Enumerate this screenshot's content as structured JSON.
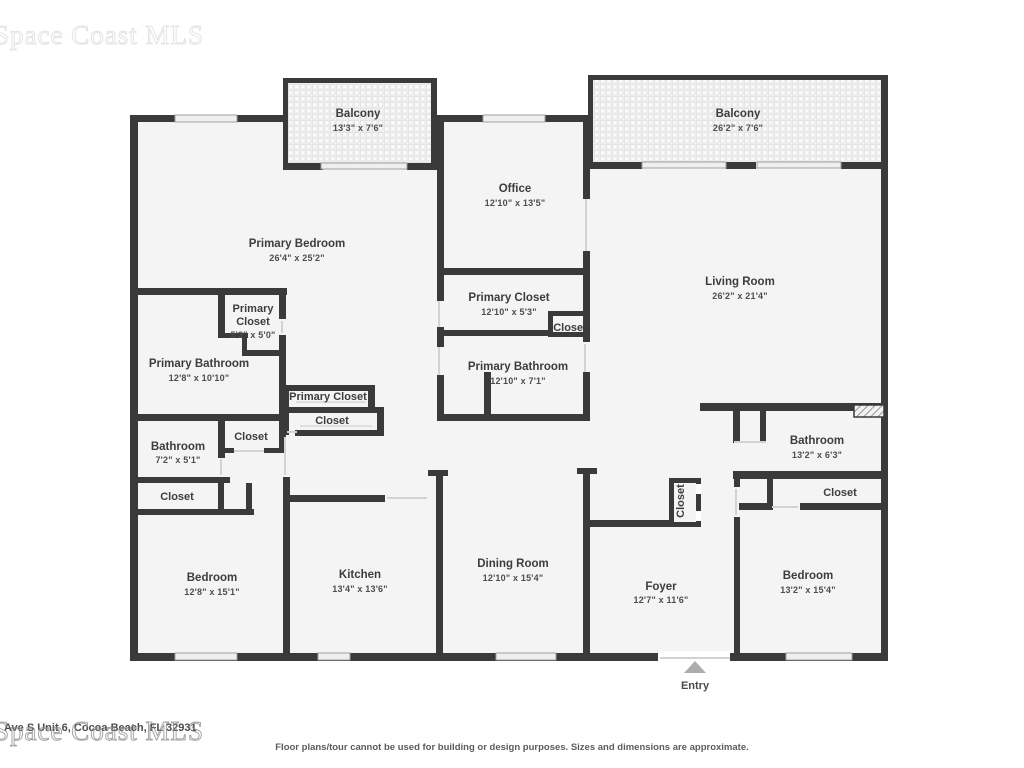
{
  "watermark": {
    "text": "Space Coast MLS"
  },
  "rooms": {
    "balcony_left": {
      "name": "Balcony",
      "dims": "13'3\" x 7'6\""
    },
    "balcony_right": {
      "name": "Balcony",
      "dims": "26'2\" x 7'6\""
    },
    "office": {
      "name": "Office",
      "dims": "12'10\" x 13'5\""
    },
    "primary_bedroom": {
      "name": "Primary Bedroom",
      "dims": "26'4\" x 25'2\""
    },
    "primary_closet_mid": {
      "name": "Primary Closet",
      "dims": "12'10\" x 5'3\""
    },
    "closet_mid": {
      "name": "Closet"
    },
    "primary_bathroom_mid": {
      "name": "Primary Bathroom",
      "dims": "12'10\" x 7'1\""
    },
    "primary_closet_small": {
      "line1": "Primary",
      "line2": "Closet",
      "dims": "5'3\" x 5'0\""
    },
    "primary_bathroom_left": {
      "name": "Primary Bathroom",
      "dims": "12'8\" x 10'10\""
    },
    "primary_closet_hall": {
      "name": "Primary Closet"
    },
    "closet_hall": {
      "name": "Closet"
    },
    "bathroom_left": {
      "name": "Bathroom",
      "dims": "7'2\" x 5'1\""
    },
    "closet_bath": {
      "name": "Closet"
    },
    "closet_bedroom_left": {
      "name": "Closet"
    },
    "bedroom_left": {
      "name": "Bedroom",
      "dims": "12'8\" x 15'1\""
    },
    "kitchen": {
      "name": "Kitchen",
      "dims": "13'4\" x 13'6\""
    },
    "living_room": {
      "name": "Living Room",
      "dims": "26'2\" x 21'4\""
    },
    "bathroom_right": {
      "name": "Bathroom",
      "dims": "13'2\" x 6'3\""
    },
    "closet_right": {
      "name": "Closet"
    },
    "dining_room": {
      "name": "Dining Room",
      "dims": "12'10\" x 15'4\""
    },
    "foyer": {
      "name": "Foyer",
      "dims": "12'7\" x 11'6\""
    },
    "closet_foyer": {
      "name": "Closet"
    },
    "bedroom_right": {
      "name": "Bedroom",
      "dims": "13'2\" x 15'4\""
    }
  },
  "entry": {
    "label": "Entry"
  },
  "footer": {
    "address": "Ave S Unit 6, Cocoa Beach, FL 32931",
    "disclaimer": "Floor plans/tour cannot be used for building or design purposes. Sizes and dimensions are approximate."
  },
  "colors": {
    "wall": "#3a3a3a",
    "floor": "#f4f4f4",
    "window": "#efefef"
  }
}
